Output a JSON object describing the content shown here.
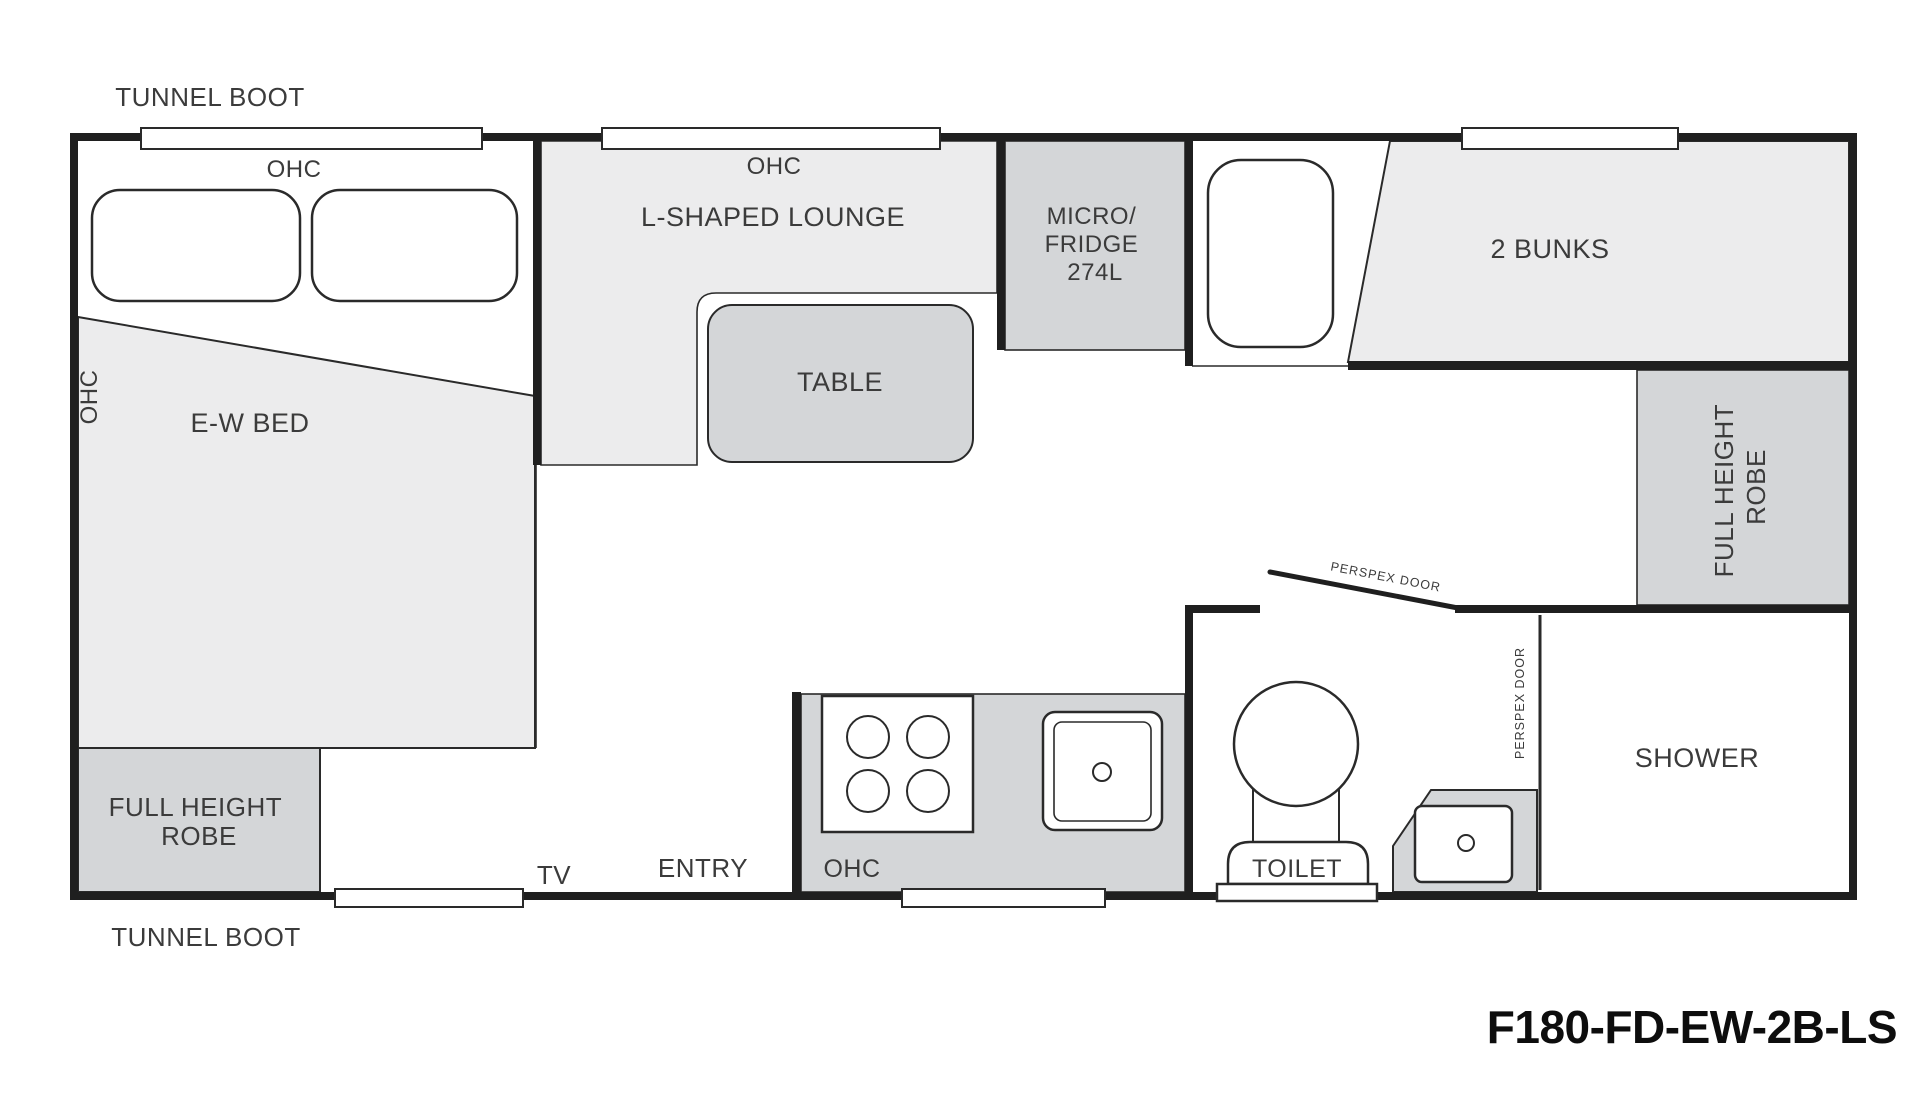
{
  "colors": {
    "floor": "#ECECED",
    "cabinet": "#D4D6D8",
    "wall": "#1F1F1F",
    "text": "#3B3B3B"
  },
  "labels": {
    "tunnel_boot_top": "TUNNEL BOOT",
    "tunnel_boot_bottom": "TUNNEL BOOT",
    "ohc_bed": "OHC",
    "ohc_side": "OHC",
    "ohc_lounge": "OHC",
    "ohc_kitchen": "OHC",
    "l_shaped_lounge": "L-SHAPED LOUNGE",
    "table": "TABLE",
    "micro_fridge": {
      "line1": "MICRO/",
      "line2": "FRIDGE",
      "line3": "274L"
    },
    "bunks": "2 BUNKS",
    "robe_right": {
      "line1": "FULL HEIGHT",
      "line2": "ROBE"
    },
    "robe_left": {
      "line1": "FULL HEIGHT",
      "line2": "ROBE"
    },
    "ew_bed": "E-W BED",
    "entry": "ENTRY",
    "tv": "TV",
    "toilet": "TOILET",
    "shower": "SHOWER",
    "perspex_door_swing": "PERSPEX DOOR",
    "perspex_door_shower": "PERSPEX DOOR",
    "model": "F180-FD-EW-2B-LS"
  }
}
